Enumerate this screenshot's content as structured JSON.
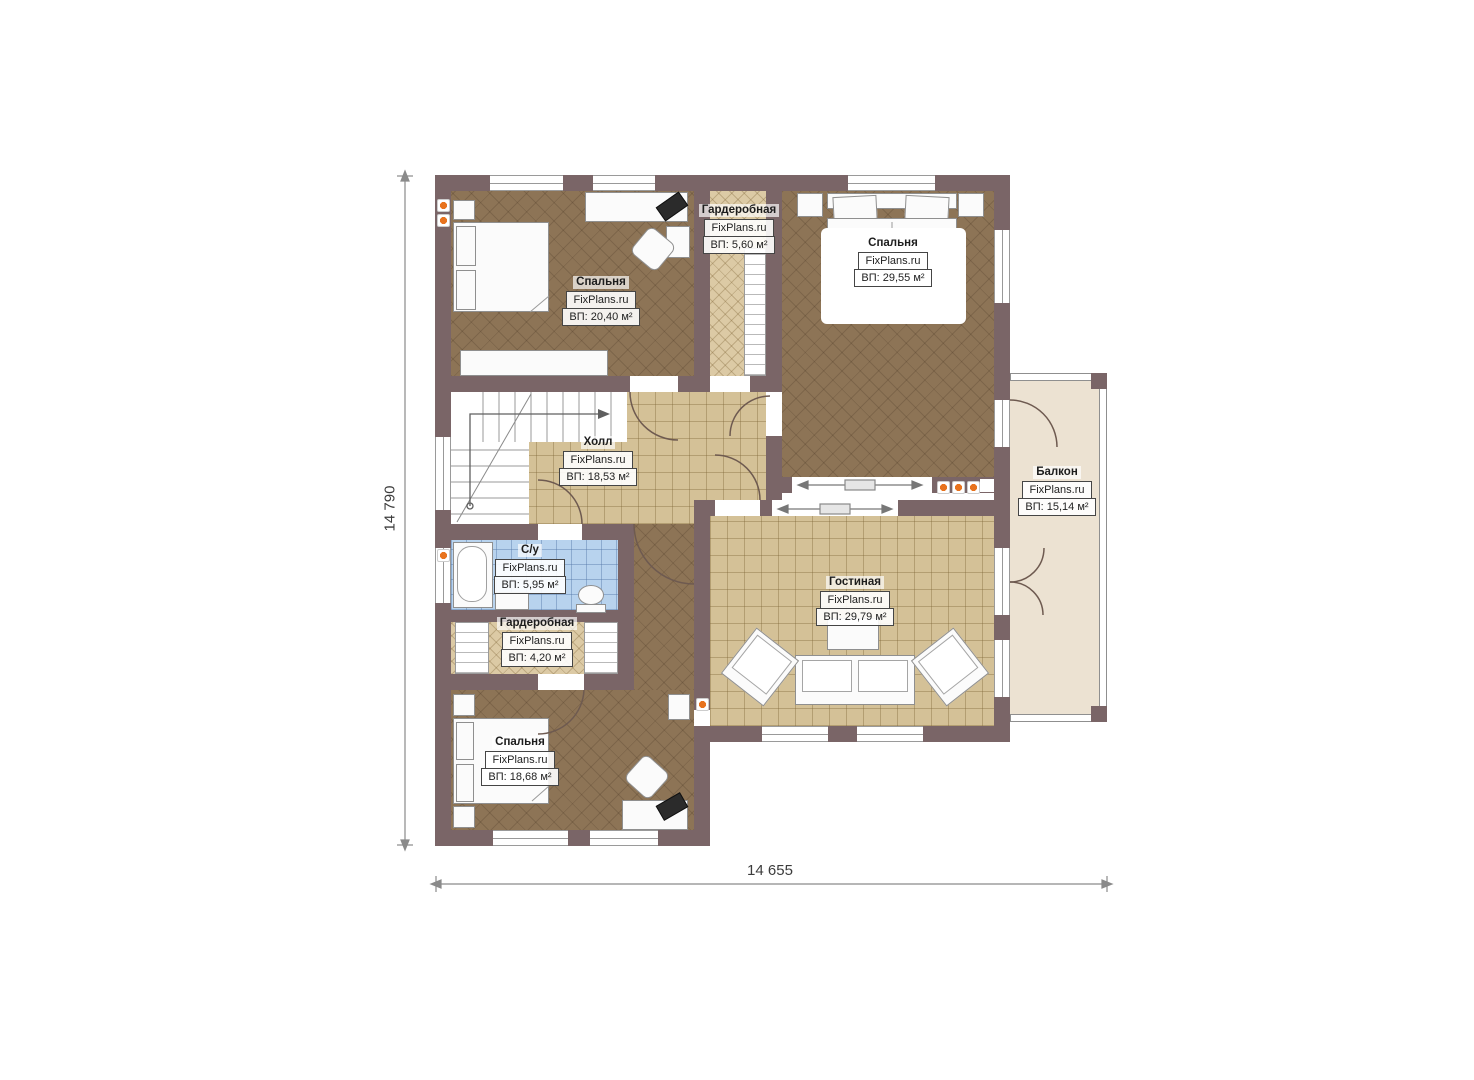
{
  "plan": {
    "brand": "FixPlans.ru",
    "rooms": [
      {
        "id": "bedroom-top-left",
        "name": "Спальня",
        "brand": "FixPlans.ru",
        "area": "ВП: 20,40 м²"
      },
      {
        "id": "wardrobe-top",
        "name": "Гардеробная",
        "brand": "FixPlans.ru",
        "area": "ВП: 5,60 м²"
      },
      {
        "id": "bedroom-top-right",
        "name": "Спальня",
        "brand": "FixPlans.ru",
        "area": "ВП: 29,55 м²"
      },
      {
        "id": "hall",
        "name": "Холл",
        "brand": "FixPlans.ru",
        "area": "ВП: 18,53 м²"
      },
      {
        "id": "bathroom",
        "name": "С/у",
        "brand": "FixPlans.ru",
        "area": "ВП: 5,95 м²"
      },
      {
        "id": "wardrobe-bottom",
        "name": "Гардеробная",
        "brand": "FixPlans.ru",
        "area": "ВП: 4,20 м²"
      },
      {
        "id": "bedroom-bottom-left",
        "name": "Спальня",
        "brand": "FixPlans.ru",
        "area": "ВП: 18,68 м²"
      },
      {
        "id": "living-room",
        "name": "Гостиная",
        "brand": "FixPlans.ru",
        "area": "ВП: 29,79 м²"
      },
      {
        "id": "balcony",
        "name": "Балкон",
        "brand": "FixPlans.ru",
        "area": "ВП: 15,14 м²"
      }
    ],
    "dimensions": {
      "height_label": "14 790",
      "width_label": "14 655"
    },
    "colors": {
      "wall": "#7a6567",
      "bedroom_floor": "#8d7456",
      "tile_floor": "#d4c197",
      "bathroom_floor": "#b8d3ee",
      "balcony_floor": "#ece2d2",
      "accent_dot": "#e8731e"
    }
  }
}
